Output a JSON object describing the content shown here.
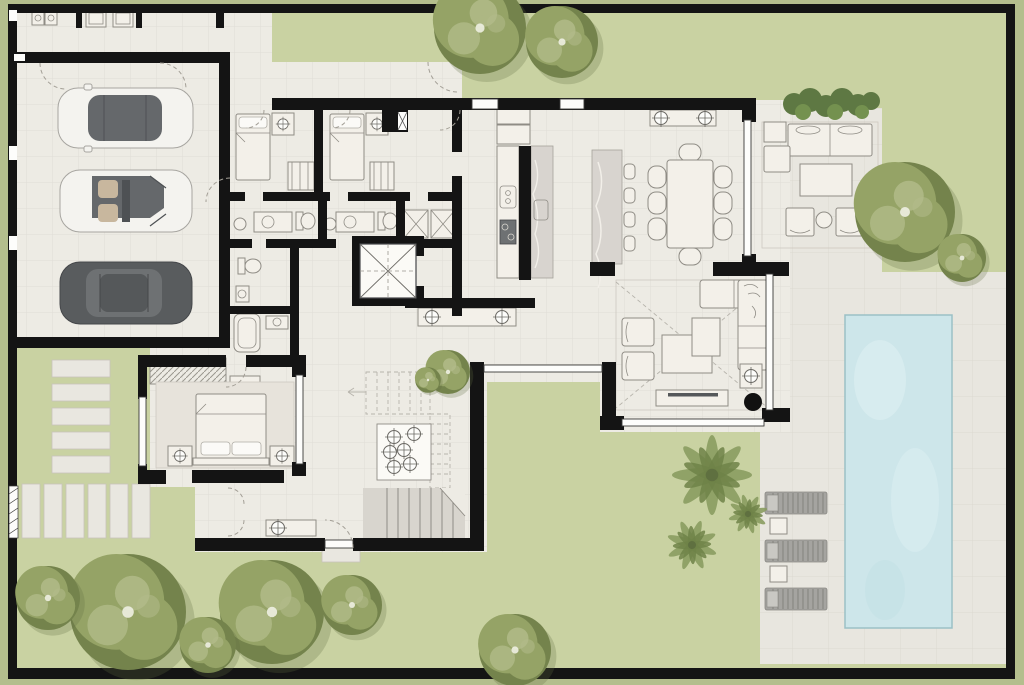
{
  "meta": {
    "title": "Villa ground-floor architectural plan, top-down rendered site view",
    "view": "top-down",
    "style": "rendered color floor plan with landscaped garden"
  },
  "palette": {
    "grass_outer": "#b4be8d",
    "lawn": "#c9d2a2",
    "floor": "#edebe4",
    "deck": "#e8e6df",
    "wall": "#141414",
    "pool_water": "#cde6ea",
    "pool_edge": "#9bc0c6",
    "marble": "#d8d4cf",
    "furniture_fill": "#f3f0e9",
    "furniture_line": "#8f8c85",
    "tree": "#95a366",
    "tree_dark": "#74834c",
    "tree_light": "#b3bc8b",
    "hedge": "#5e7843",
    "palm": "#8a9c60",
    "palm_dark": "#6f8248",
    "car_white": "#f4f3ef",
    "car_dark": "#595c5e",
    "car_glass": "#65686b",
    "seat_tan": "#c8b79e",
    "lounger": "#a5a4a0",
    "stone": "#e9e7e0",
    "rug": "#e7e3db",
    "stair": "#d8d5ce"
  },
  "features": {
    "site": "walled rectangular plot with lawn, boundary wall and specimen trees",
    "garage": {
      "name": "three-car garage",
      "vehicles": [
        "white-sedan-dark-roof",
        "white-convertible-tan-seats",
        "grey-hatchback"
      ]
    },
    "utility_room": "laundry strip with washer and dryer appliances",
    "guest_bedroom_1": "single bed, nightstand, wardrobe, en-suite bath",
    "guest_bedroom_2": "single bed, nightstand, wardrobe, en-suite bath",
    "master_bedroom": "double bed on rug, two nightstands with lamps, wardrobe, en-suite with bathtub",
    "elevator": "lift cab marked with X and dashed cross",
    "stairs": "lower flight, dashed upper flight and ceiling spotlight panel",
    "kitchen": "galley kitchen, double counters with sink and cooktop, marble worktop",
    "dining_room": "eight-seat dining table, marble buffet with four stools, console with two lamps",
    "living_room": "L-shaped sofa, two armchairs, nested coffee tables, TV console, black floor lamp",
    "terrace": "covered outdoor lounge: sofa, two club chairs, coffee table, hedge planter",
    "inner_courtyard": "green light-well with small olive trees",
    "pool_area": "rectangular swimming pool on stone deck, three slatted sun loungers with side tables, palm cluster",
    "entry": "south door with stepping-stone path, paver band and side gate"
  }
}
